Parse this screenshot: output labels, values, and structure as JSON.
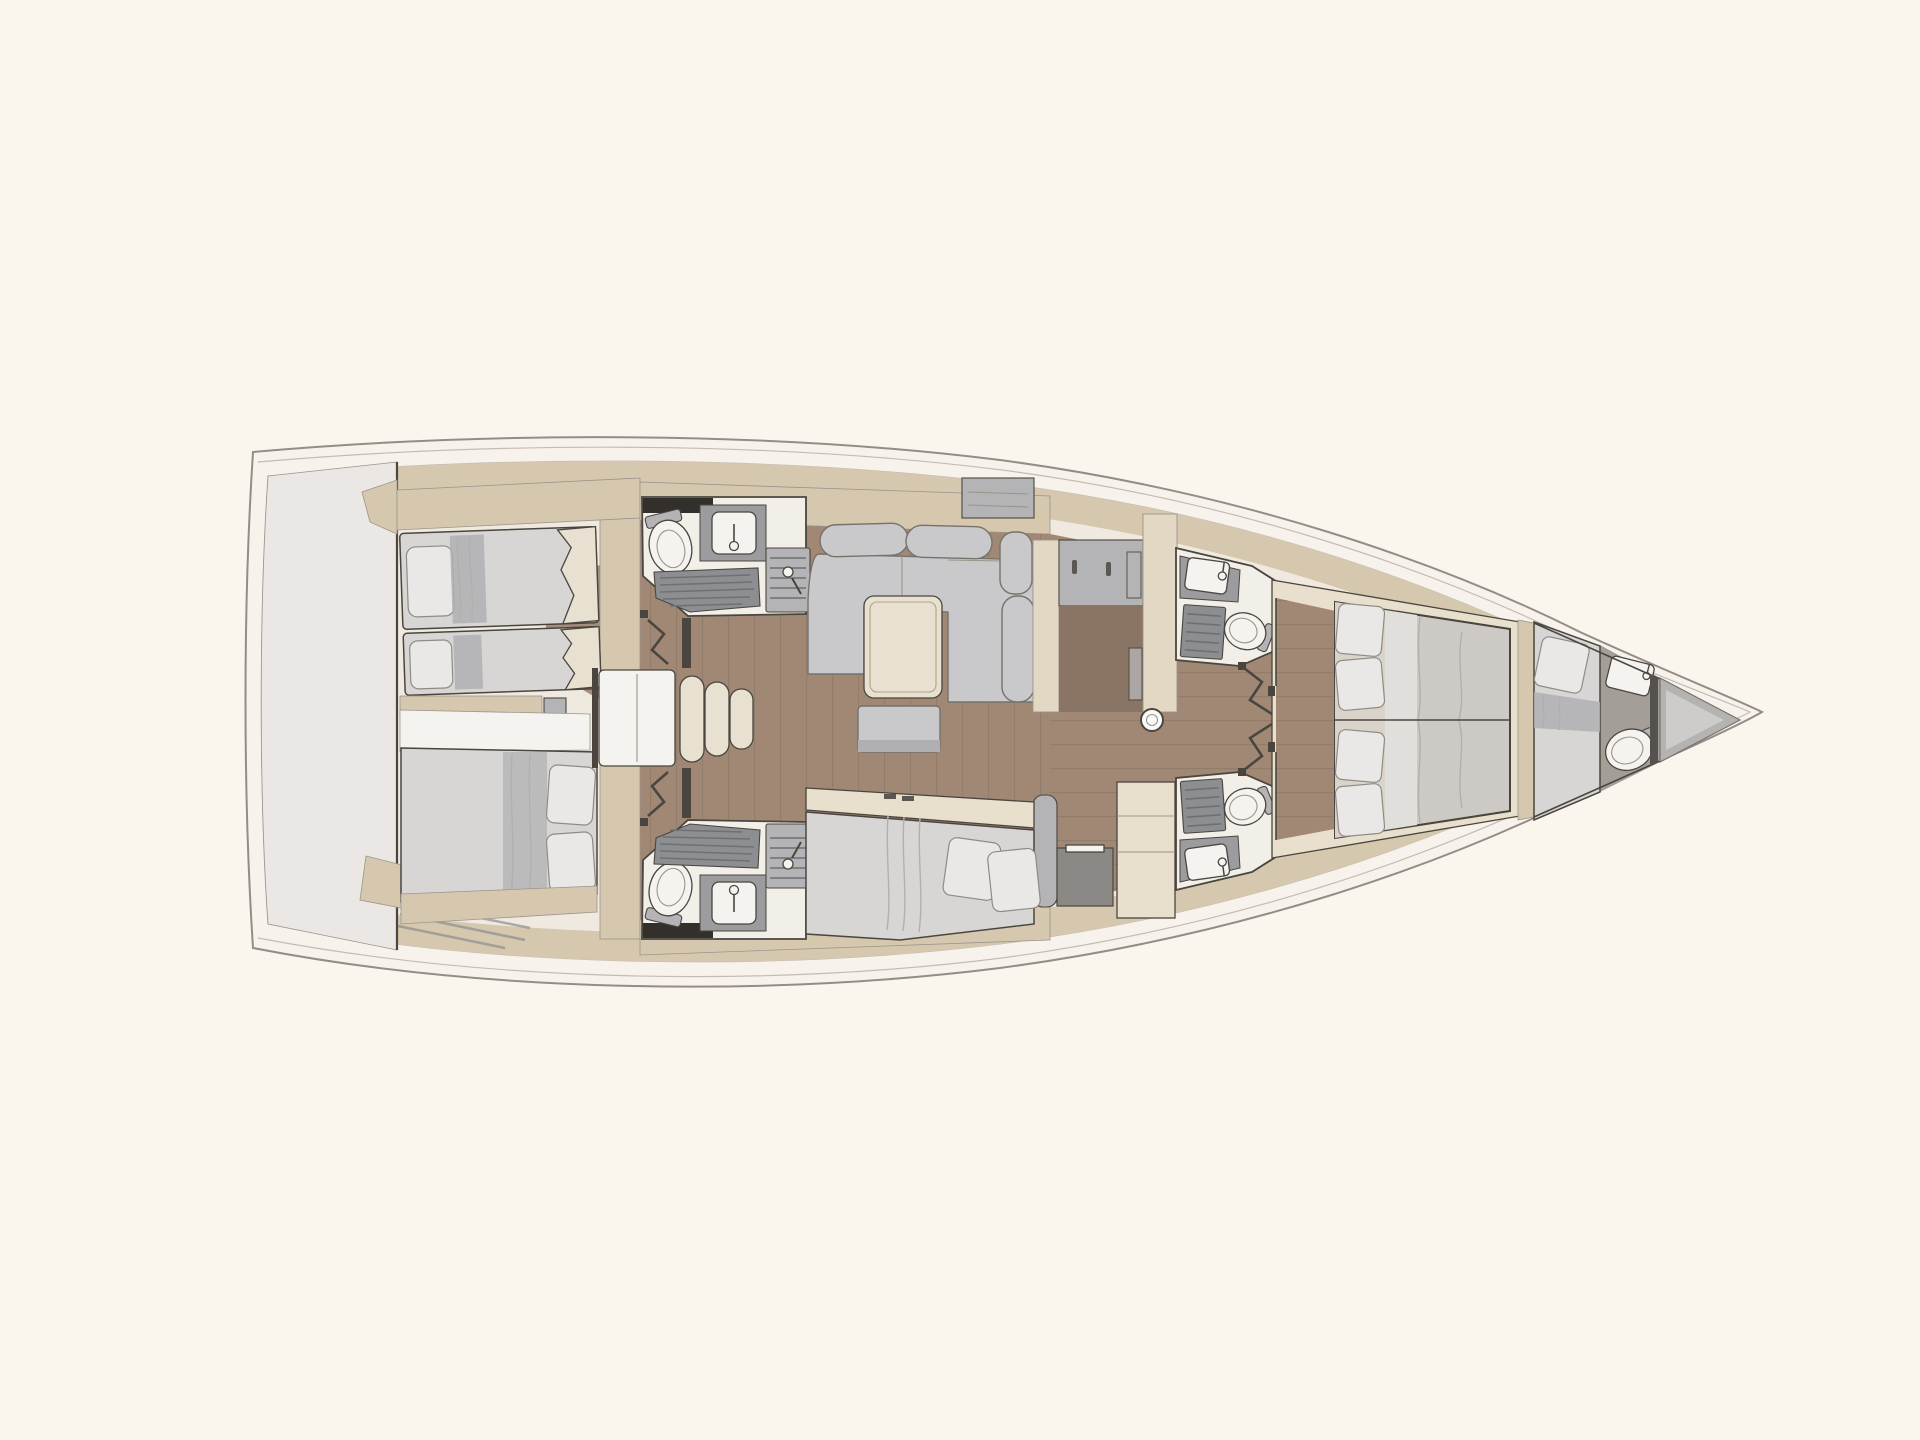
{
  "figure": {
    "type": "diagram",
    "subject": "Sailing yacht interior layout floor plan",
    "view": "overhead deck plan, bow pointing right, stern at left",
    "features": [
      "aft-deck",
      "aft-cabin-port-twin-beds",
      "aft-cabin-starboard-double-bed",
      "companionway-stairs",
      "aft-head-port",
      "aft-head-starboard",
      "saloon-c-shaped-sofa",
      "saloon-table",
      "saloon-bench",
      "port-vestibule-wardrobe",
      "galley-landing",
      "mast-post",
      "starboard-berth",
      "forward-head-port",
      "forward-head-starboard",
      "accordion-doors",
      "owner-cabin-double-bed",
      "crew-cabin-berth",
      "crew-toilet",
      "crew-sink",
      "bow-sail-locker"
    ]
  },
  "palette": {
    "background": "#faf6ee",
    "hull_fill": "#f7f3ec",
    "hull_stroke": "#958d85",
    "deck_line": "#c4bcb2",
    "interior_base": "#efe9e0",
    "aft_deck": "#eae7e5",
    "wall_beige": "#d5c8ae",
    "trim_beige": "#e2d8c4",
    "furniture_cream": "#e8dfcc",
    "mattress_cream": "#e8e0d0",
    "wood_floor": "#a08875",
    "wood_dark": "#8a7463",
    "wood_line": "#7c6a5a",
    "upholstery": "#c9c8ca",
    "upholstery_dark": "#b0afb2",
    "linen": "#d8d6d4",
    "pillow": "#eae8e6",
    "fixture_white": "#f5f3ef",
    "head_floor": "#f2efe9",
    "panel_gray": "#b4b3b5",
    "counter_gray": "#9c9c9e",
    "slat_gray": "#8d8e91",
    "crew_floor": "#a39e97",
    "bow_glass": "#b5b3b2",
    "dark_line": "#4a463f",
    "dark_locker": "#33302c",
    "line_mid": "#9b948b"
  }
}
